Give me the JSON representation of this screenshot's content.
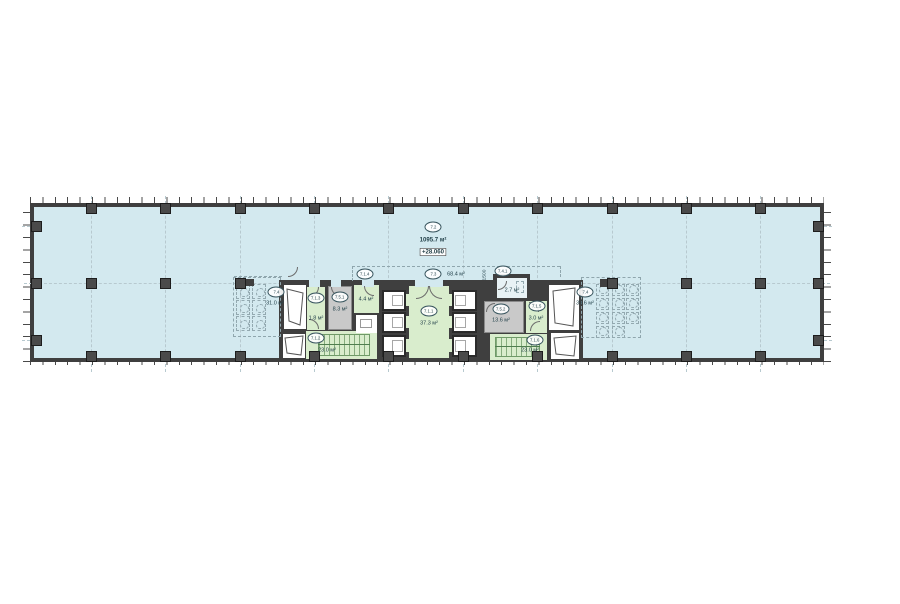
{
  "drawing": {
    "rooms": {
      "main": {
        "code": "7.2",
        "area": "1095.7 м²",
        "elevation": "+28.060"
      },
      "corridor": {
        "code": "7.3",
        "area": "68.4 м²"
      },
      "lobby": {
        "code": "7.1.1",
        "area": "37.3 м²"
      },
      "stair_left": {
        "code": "7.1.2",
        "area": "23.0 м²"
      },
      "vestibule_left": {
        "code": "7.1.3",
        "area": "1.8 м²"
      },
      "room_414": {
        "code": "7.1.4",
        "area": "4.4 м²"
      },
      "vestibule_right": {
        "code": "7.1.5",
        "area": "3.0 м²"
      },
      "stair_right": {
        "code": "7.1.6",
        "area": "23.0 м²"
      },
      "wc_left": {
        "code": "7.4",
        "area": "31.0 м²"
      },
      "wc_accessible": {
        "code": "7.4.1",
        "area": "2.7 м²"
      },
      "wc_right": {
        "code": "7.4",
        "area": "39.6 м²"
      },
      "tech_left": {
        "code": "7.5.1",
        "area": "8.3 м²"
      },
      "tech_right": {
        "code": "7.5.2",
        "area": "13.6 м²"
      }
    },
    "dimensions": {
      "shaft_width": "1500"
    },
    "colors": {
      "floor": "#d3e9ef",
      "room_green": "#d9edcd",
      "room_gray": "#c9c9c9",
      "wall": "#3f3f3f",
      "dashed_line": "#8fa6ad"
    }
  }
}
